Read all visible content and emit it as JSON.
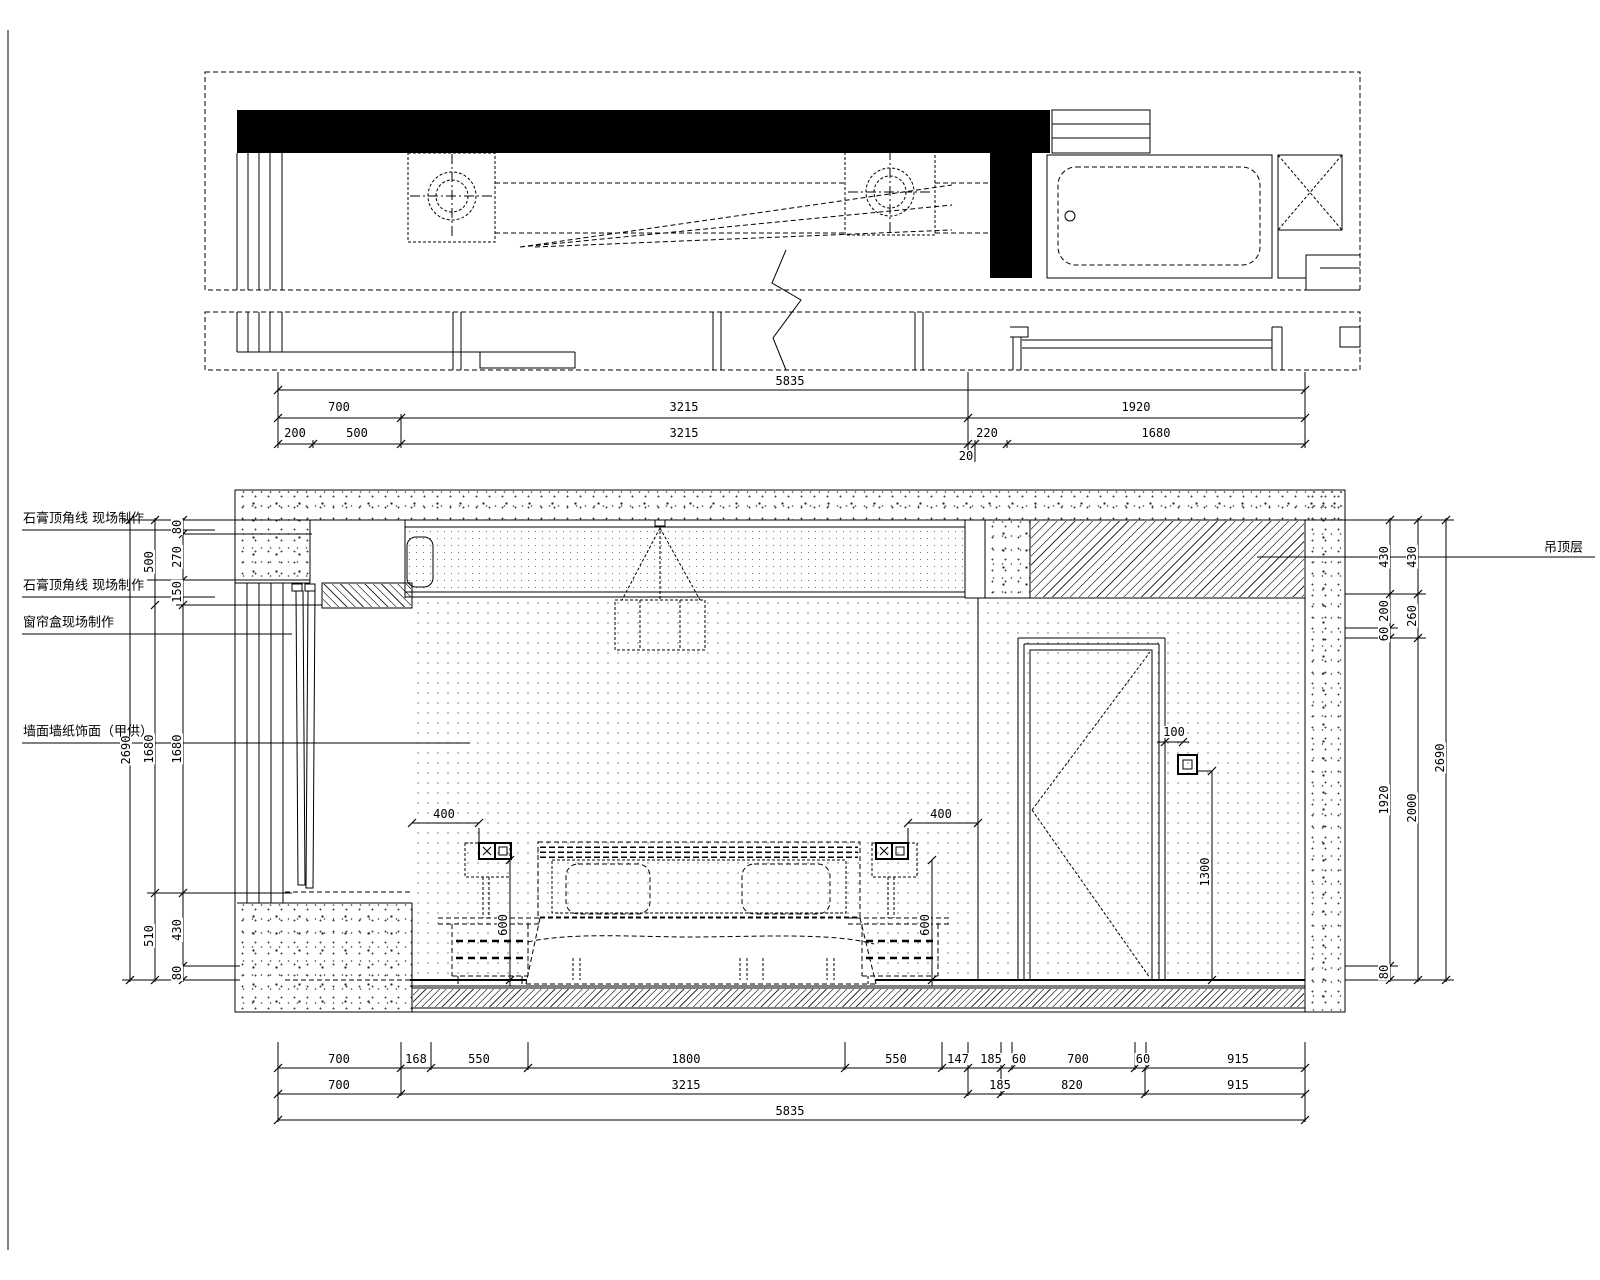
{
  "drawing": {
    "type": "interior-elevation-cad",
    "line_color": "#000000",
    "background": "#ffffff",
    "annotations": {
      "left": [
        "石膏顶角线 现场制作",
        "石膏顶角线 现场制作",
        "窗帘盒现场制作",
        "墙面墙纸饰面（甲供）"
      ],
      "right": [
        "吊顶层"
      ]
    },
    "dimensions": {
      "top_rows": [
        [
          "5835"
        ],
        [
          "700",
          "3215",
          "1920"
        ],
        [
          "200",
          "500",
          "3215",
          "220",
          "1680"
        ],
        [
          "20"
        ]
      ],
      "bottom_rows": [
        [
          "700",
          "168",
          "550",
          "1800",
          "550",
          "147",
          "185",
          "60",
          "700",
          "60",
          "915"
        ],
        [
          "700",
          "3215",
          "185",
          "820",
          "915"
        ],
        [
          "5835"
        ]
      ],
      "left_column": [
        "2690",
        "500",
        "1680",
        "510",
        "80",
        "270",
        "150",
        "1680",
        "430",
        "80"
      ],
      "right_column": [
        "430",
        "430",
        "200",
        "60",
        "260",
        "1920",
        "2000",
        "2690",
        "80"
      ],
      "detail": [
        "400",
        "400",
        "600",
        "600",
        "100",
        "1300"
      ]
    },
    "labels": [
      {
        "n": "dim-top-total",
        "t": "5835",
        "x": 790,
        "y": 381
      },
      {
        "n": "dim-top",
        "t": "700",
        "x": 339,
        "y": 407
      },
      {
        "n": "dim-top",
        "t": "3215",
        "x": 684,
        "y": 407
      },
      {
        "n": "dim-top",
        "t": "1920",
        "x": 1136,
        "y": 407
      },
      {
        "n": "dim-top",
        "t": "200",
        "x": 295,
        "y": 433
      },
      {
        "n": "dim-top",
        "t": "500",
        "x": 357,
        "y": 433
      },
      {
        "n": "dim-top",
        "t": "3215",
        "x": 684,
        "y": 433
      },
      {
        "n": "dim-top",
        "t": "220",
        "x": 987,
        "y": 433
      },
      {
        "n": "dim-top",
        "t": "1680",
        "x": 1156,
        "y": 433
      },
      {
        "n": "dim-top",
        "t": "20",
        "x": 966,
        "y": 456
      },
      {
        "n": "dim-bottom",
        "t": "700",
        "x": 339,
        "y": 1059
      },
      {
        "n": "dim-bottom",
        "t": "168",
        "x": 416,
        "y": 1059
      },
      {
        "n": "dim-bottom",
        "t": "550",
        "x": 479,
        "y": 1059
      },
      {
        "n": "dim-bottom",
        "t": "1800",
        "x": 686,
        "y": 1059
      },
      {
        "n": "dim-bottom",
        "t": "550",
        "x": 896,
        "y": 1059
      },
      {
        "n": "dim-bottom",
        "t": "147",
        "x": 958,
        "y": 1059
      },
      {
        "n": "dim-bottom",
        "t": "185",
        "x": 991,
        "y": 1059
      },
      {
        "n": "dim-bottom",
        "t": "60",
        "x": 1019,
        "y": 1059
      },
      {
        "n": "dim-bottom",
        "t": "700",
        "x": 1078,
        "y": 1059
      },
      {
        "n": "dim-bottom",
        "t": "60",
        "x": 1143,
        "y": 1059
      },
      {
        "n": "dim-bottom",
        "t": "915",
        "x": 1238,
        "y": 1059
      },
      {
        "n": "dim-bottom",
        "t": "700",
        "x": 339,
        "y": 1085
      },
      {
        "n": "dim-bottom",
        "t": "3215",
        "x": 686,
        "y": 1085
      },
      {
        "n": "dim-bottom",
        "t": "185",
        "x": 1000,
        "y": 1085
      },
      {
        "n": "dim-bottom",
        "t": "820",
        "x": 1072,
        "y": 1085
      },
      {
        "n": "dim-bottom",
        "t": "915",
        "x": 1238,
        "y": 1085
      },
      {
        "n": "dim-bottom-total",
        "t": "5835",
        "x": 790,
        "y": 1111
      },
      {
        "n": "dim-left",
        "t": "2690",
        "x": 126,
        "y": 750,
        "r": 1
      },
      {
        "n": "dim-left",
        "t": "500",
        "x": 149,
        "y": 562,
        "r": 1
      },
      {
        "n": "dim-left",
        "t": "1680",
        "x": 149,
        "y": 749,
        "r": 1
      },
      {
        "n": "dim-left",
        "t": "510",
        "x": 149,
        "y": 936,
        "r": 1
      },
      {
        "n": "dim-left",
        "t": "80",
        "x": 177,
        "y": 527,
        "r": 1
      },
      {
        "n": "dim-left",
        "t": "270",
        "x": 177,
        "y": 557,
        "r": 1
      },
      {
        "n": "dim-left",
        "t": "150",
        "x": 177,
        "y": 592,
        "r": 1
      },
      {
        "n": "dim-left",
        "t": "1680",
        "x": 177,
        "y": 749,
        "r": 1
      },
      {
        "n": "dim-left",
        "t": "430",
        "x": 177,
        "y": 930,
        "r": 1
      },
      {
        "n": "dim-left",
        "t": "80",
        "x": 177,
        "y": 973,
        "r": 1
      },
      {
        "n": "dim-right",
        "t": "430",
        "x": 1384,
        "y": 557,
        "r": 1
      },
      {
        "n": "dim-right",
        "t": "200",
        "x": 1384,
        "y": 611,
        "r": 1
      },
      {
        "n": "dim-right",
        "t": "60",
        "x": 1384,
        "y": 634,
        "r": 1
      },
      {
        "n": "dim-right",
        "t": "1920",
        "x": 1384,
        "y": 800,
        "r": 1
      },
      {
        "n": "dim-right",
        "t": "80",
        "x": 1384,
        "y": 972,
        "r": 1
      },
      {
        "n": "dim-right",
        "t": "430",
        "x": 1412,
        "y": 557,
        "r": 1
      },
      {
        "n": "dim-right",
        "t": "260",
        "x": 1412,
        "y": 616,
        "r": 1
      },
      {
        "n": "dim-right",
        "t": "2000",
        "x": 1412,
        "y": 808,
        "r": 1
      },
      {
        "n": "dim-right",
        "t": "2690",
        "x": 1440,
        "y": 758,
        "r": 1
      },
      {
        "n": "dim-socket-left",
        "t": "400",
        "x": 444,
        "y": 814
      },
      {
        "n": "dim-socket-right",
        "t": "400",
        "x": 941,
        "y": 814
      },
      {
        "n": "dim-socket-height-left",
        "t": "600",
        "x": 503,
        "y": 925,
        "r": 1
      },
      {
        "n": "dim-socket-height-right",
        "t": "600",
        "x": 925,
        "y": 925,
        "r": 1
      },
      {
        "n": "dim-switch-offset",
        "t": "100",
        "x": 1174,
        "y": 732
      },
      {
        "n": "dim-switch-height",
        "t": "1300",
        "x": 1205,
        "y": 872,
        "r": 1
      },
      {
        "n": "note-crown-molding-1",
        "t": "石膏顶角线 现场制作",
        "x": 22,
        "y": 517,
        "c": "ann"
      },
      {
        "n": "note-crown-molding-2",
        "t": "石膏顶角线 现场制作",
        "x": 22,
        "y": 584,
        "c": "ann"
      },
      {
        "n": "note-curtain-box",
        "t": "窗帘盒现场制作",
        "x": 22,
        "y": 621,
        "c": "ann"
      },
      {
        "n": "note-wallpaper",
        "t": "墙面墙纸饰面（甲供）",
        "x": 22,
        "y": 730,
        "c": "ann"
      },
      {
        "n": "note-ceiling-layer",
        "t": "吊顶层",
        "x": 1543,
        "y": 546,
        "c": "ann"
      }
    ]
  }
}
